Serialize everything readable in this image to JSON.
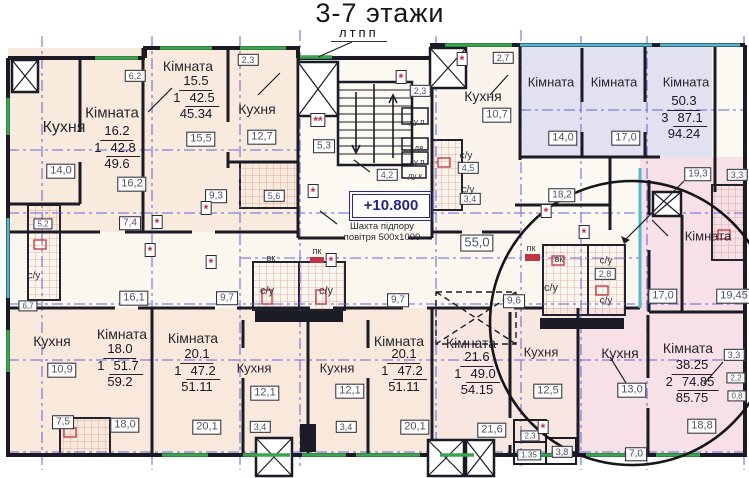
{
  "title": "3-7 этажи",
  "top_label": "лтпп",
  "core": {
    "elevation": "+10.800",
    "shaft_note_1": "Шахта підпору",
    "shaft_note_2": "повітря 500х1000"
  },
  "colors": {
    "wall": "#1b1b26",
    "axis_blue": "#5c5cd6",
    "window_green": "#3aa44e",
    "window_teal": "#55b7cd",
    "detail_red": "#c03545",
    "cream_apartment": "#f8eadd",
    "lavender_apartment": "#e1e1f0",
    "pink_apartment": "#f7e0e6"
  },
  "stats": [
    {
      "name": "apartment-top-left",
      "x": 117,
      "y": 124,
      "room": "16.2",
      "count": "1",
      "living": "42.8",
      "total": "49.6"
    },
    {
      "name": "apartment-top-2",
      "x": 196,
      "y": 74,
      "room": "15.5",
      "count": "1",
      "living": "42.5",
      "total": "45.34"
    },
    {
      "name": "apartment-top-right",
      "x": 684,
      "y": 94,
      "room": "50.3",
      "count": "3",
      "living": "87.1",
      "total": "94.24"
    },
    {
      "name": "apartment-bottom-left",
      "x": 120,
      "y": 342,
      "room": "18.0",
      "count": "1",
      "living": "51.7",
      "total": "59.2"
    },
    {
      "name": "apartment-bottom-2",
      "x": 197,
      "y": 347,
      "room": "20.1",
      "count": "1",
      "living": "47.2",
      "total": "51.11"
    },
    {
      "name": "apartment-bottom-3",
      "x": 404,
      "y": 347,
      "room": "20.1",
      "count": "1",
      "living": "47.2",
      "total": "51.11"
    },
    {
      "name": "apartment-bottom-4",
      "x": 477,
      "y": 350,
      "room": "21.6",
      "count": "1",
      "living": "49.0",
      "total": "54.15"
    },
    {
      "name": "apartment-bottom-right",
      "x": 692,
      "y": 358,
      "room": "38.25",
      "count": "2",
      "living": "74.85",
      "total": "85.75"
    }
  ],
  "room_names": [
    {
      "t": "Кухня",
      "x": 64,
      "y": 128,
      "fs": 16
    },
    {
      "t": "Кімната",
      "x": 112,
      "y": 113,
      "fs": 15
    },
    {
      "t": "Кімната",
      "x": 188,
      "y": 66,
      "fs": 14
    },
    {
      "t": "Кухня",
      "x": 257,
      "y": 109,
      "fs": 14
    },
    {
      "t": "Кухня",
      "x": 483,
      "y": 96,
      "fs": 14
    },
    {
      "t": "Кімната",
      "x": 551,
      "y": 82,
      "fs": 13
    },
    {
      "t": "Кімната",
      "x": 614,
      "y": 82,
      "fs": 13
    },
    {
      "t": "Кімната",
      "x": 686,
      "y": 82,
      "fs": 13
    },
    {
      "t": "Кімната",
      "x": 708,
      "y": 236,
      "fs": 13
    },
    {
      "t": "Кімната",
      "x": 122,
      "y": 334,
      "fs": 14
    },
    {
      "t": "Кухня",
      "x": 52,
      "y": 341,
      "fs": 14
    },
    {
      "t": "Кімната",
      "x": 193,
      "y": 338,
      "fs": 14
    },
    {
      "t": "Кухня",
      "x": 254,
      "y": 368,
      "fs": 13
    },
    {
      "t": "Кухня",
      "x": 337,
      "y": 368,
      "fs": 13
    },
    {
      "t": "Кімната",
      "x": 399,
      "y": 341,
      "fs": 14
    },
    {
      "t": "Кімната",
      "x": 471,
      "y": 343,
      "fs": 14
    },
    {
      "t": "Кухня",
      "x": 541,
      "y": 352,
      "fs": 13
    },
    {
      "t": "Кухня",
      "x": 620,
      "y": 353,
      "fs": 14
    },
    {
      "t": "Кімната",
      "x": 688,
      "y": 348,
      "fs": 14
    }
  ],
  "area_boxes": [
    {
      "t": "6,2",
      "x": 135,
      "y": 76,
      "fs": 9
    },
    {
      "t": "14,0",
      "x": 61,
      "y": 171
    },
    {
      "t": "16,2",
      "x": 132,
      "y": 184
    },
    {
      "t": "15,5",
      "x": 201,
      "y": 139
    },
    {
      "t": "12,7",
      "x": 262,
      "y": 137
    },
    {
      "t": "2,3",
      "x": 248,
      "y": 60,
      "fs": 9
    },
    {
      "t": "9,3",
      "x": 216,
      "y": 196,
      "fs": 10
    },
    {
      "t": "5,6",
      "x": 274,
      "y": 196,
      "fs": 9
    },
    {
      "t": "5,3",
      "x": 324,
      "y": 146,
      "fs": 10
    },
    {
      "t": "2,3",
      "x": 420,
      "y": 91,
      "fs": 9
    },
    {
      "t": "4,2",
      "x": 387,
      "y": 175,
      "fs": 9
    },
    {
      "t": "2,7",
      "x": 503,
      "y": 58,
      "fs": 9
    },
    {
      "t": "10,7",
      "x": 497,
      "y": 115
    },
    {
      "t": "4,5",
      "x": 468,
      "y": 168,
      "fs": 9
    },
    {
      "t": "3,4",
      "x": 470,
      "y": 199,
      "fs": 9
    },
    {
      "t": "14,0",
      "x": 563,
      "y": 138
    },
    {
      "t": "17,0",
      "x": 626,
      "y": 138
    },
    {
      "t": "19,3",
      "x": 698,
      "y": 174,
      "fs": 10
    },
    {
      "t": "3,3",
      "x": 737,
      "y": 175,
      "fs": 9
    },
    {
      "t": "18,2",
      "x": 562,
      "y": 195,
      "fs": 10
    },
    {
      "t": "7,4",
      "x": 130,
      "y": 223,
      "fs": 10
    },
    {
      "t": "16,1",
      "x": 134,
      "y": 298
    },
    {
      "t": "9,7",
      "x": 227,
      "y": 298,
      "fs": 10
    },
    {
      "t": "9,7",
      "x": 398,
      "y": 300,
      "fs": 10
    },
    {
      "t": "55,0",
      "x": 477,
      "y": 243,
      "fs": 13
    },
    {
      "t": "9,6",
      "x": 514,
      "y": 301,
      "fs": 10
    },
    {
      "t": "10,9",
      "x": 62,
      "y": 370
    },
    {
      "t": "7,5",
      "x": 63,
      "y": 422,
      "fs": 10
    },
    {
      "t": "18,0",
      "x": 125,
      "y": 425
    },
    {
      "t": "20,1",
      "x": 207,
      "y": 427
    },
    {
      "t": "12,1",
      "x": 265,
      "y": 393
    },
    {
      "t": "3,4",
      "x": 260,
      "y": 427,
      "fs": 9
    },
    {
      "t": "12,1",
      "x": 350,
      "y": 391
    },
    {
      "t": "3,4",
      "x": 346,
      "y": 427,
      "fs": 9
    },
    {
      "t": "20,1",
      "x": 415,
      "y": 427
    },
    {
      "t": "21,6",
      "x": 492,
      "y": 430
    },
    {
      "t": "12,5",
      "x": 548,
      "y": 391
    },
    {
      "t": "2,3",
      "x": 530,
      "y": 436,
      "fs": 8
    },
    {
      "t": "1.35",
      "x": 529,
      "y": 455,
      "fs": 8
    },
    {
      "t": "3,8",
      "x": 562,
      "y": 452,
      "fs": 9
    },
    {
      "t": "13,0",
      "x": 632,
      "y": 390
    },
    {
      "t": "18,8",
      "x": 702,
      "y": 426
    },
    {
      "t": "3,3",
      "x": 734,
      "y": 355,
      "fs": 9
    },
    {
      "t": "7,0",
      "x": 636,
      "y": 454,
      "fs": 10
    },
    {
      "t": "17,0",
      "x": 663,
      "y": 296
    },
    {
      "t": "19,45",
      "x": 734,
      "y": 296
    },
    {
      "t": "2,8",
      "x": 605,
      "y": 274,
      "fs": 9
    },
    {
      "t": "5,2",
      "x": 43,
      "y": 224,
      "fs": 8
    },
    {
      "t": "6,7",
      "x": 28,
      "y": 306,
      "fs": 8
    },
    {
      "t": "2,2",
      "x": 736,
      "y": 378,
      "fs": 8
    },
    {
      "t": "0,8",
      "x": 737,
      "y": 396,
      "fs": 8
    }
  ],
  "small_texts": [
    {
      "t": "с/у",
      "x": 34,
      "y": 276,
      "fs": 10
    },
    {
      "t": "с/у",
      "x": 267,
      "y": 291,
      "fs": 11
    },
    {
      "t": "с/у",
      "x": 326,
      "y": 291,
      "fs": 11
    },
    {
      "t": "с/у",
      "x": 466,
      "y": 156,
      "fs": 10
    },
    {
      "t": "с/у",
      "x": 468,
      "y": 190,
      "fs": 10
    },
    {
      "t": "с/у",
      "x": 551,
      "y": 288,
      "fs": 11
    },
    {
      "t": "с/у",
      "x": 606,
      "y": 261,
      "fs": 10
    },
    {
      "t": "с/у",
      "x": 606,
      "y": 301,
      "fs": 10
    },
    {
      "t": "вк",
      "x": 271,
      "y": 258,
      "fs": 9
    },
    {
      "t": "вк",
      "x": 559,
      "y": 259,
      "fs": 9
    },
    {
      "t": "пк",
      "x": 317,
      "y": 251,
      "fs": 9
    },
    {
      "t": "пк",
      "x": 531,
      "y": 248,
      "fs": 9
    },
    {
      "t": "ду п",
      "x": 417,
      "y": 122,
      "fs": 8
    },
    {
      "t": "дв",
      "x": 419,
      "y": 148,
      "fs": 8
    },
    {
      "t": "ду п",
      "x": 417,
      "y": 162,
      "fs": 8
    },
    {
      "t": "ду к",
      "x": 415,
      "y": 176,
      "fs": 8
    }
  ],
  "markers": [
    {
      "t": "**",
      "x": 318,
      "y": 120
    },
    {
      "t": "*",
      "x": 401,
      "y": 77
    },
    {
      "t": "*",
      "x": 313,
      "y": 191
    },
    {
      "t": "*",
      "x": 206,
      "y": 208
    },
    {
      "t": "*",
      "x": 157,
      "y": 222
    },
    {
      "t": "*",
      "x": 150,
      "y": 250
    },
    {
      "t": "*",
      "x": 211,
      "y": 262
    },
    {
      "t": "*",
      "x": 331,
      "y": 260
    },
    {
      "t": "*",
      "x": 546,
      "y": 211
    },
    {
      "t": "*",
      "x": 584,
      "y": 232
    },
    {
      "t": "*",
      "x": 462,
      "y": 59
    },
    {
      "t": "*",
      "x": 543,
      "y": 427
    }
  ]
}
